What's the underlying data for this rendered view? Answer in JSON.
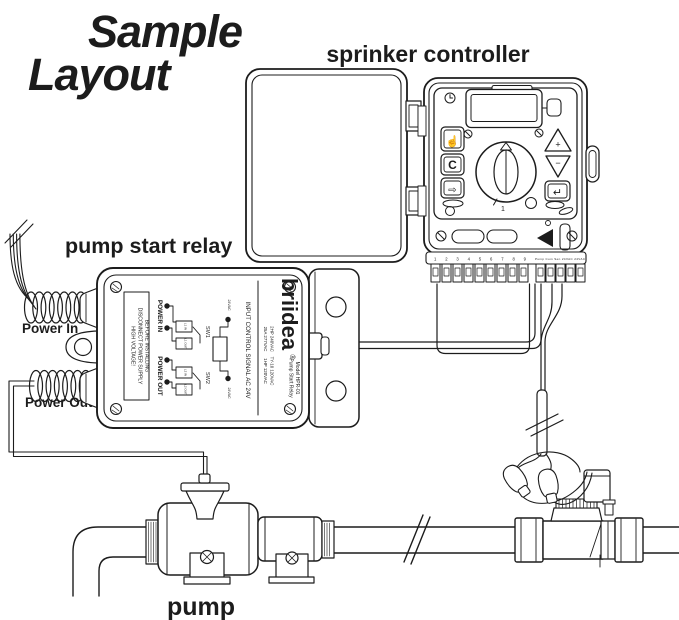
{
  "colors": {
    "accent": "#4f9c87",
    "line": "#1c1c1c"
  },
  "title": {
    "line1": "Sample",
    "line2": "Layout"
  },
  "labels": {
    "controller": "sprinker controller",
    "relay": "pump start relay",
    "power_in": "Power In",
    "power_out": "Power Out",
    "pump": "pump"
  },
  "relay_panel": {
    "brand": "briidea",
    "reg": "®",
    "model_line1": "Pump Start Relay",
    "model_line2": "Model HPR-01",
    "rating1a": "25A 277VAC",
    "rating1b": "2HP 240VAC",
    "rating2a": "1HP 120VAC",
    "rating2b": "TY-10 120VAC",
    "warning1": "HIGH VOLTAGE!",
    "warning2": "DISCONNECT POWER SUPPLY",
    "warning3": "BEFORE INSTALLING",
    "power_in": "POWER IN",
    "power_out": "POWER OUT",
    "sw1": "SW1",
    "sw2": "SW2",
    "t1": "L1 IN",
    "t2": "L1 OUT",
    "t3": "L2 IN",
    "t4": "L2 OUT",
    "vac_top": "24VAC",
    "vac_bot": "24VAC",
    "signal": "INPUT CONTROL SIGNAL AC 24V"
  },
  "controller_panel": {
    "btn_manual": "☝",
    "btn_c": "C",
    "btn_next": "⇨",
    "btn_plus": "+",
    "btn_minus": "−",
    "btn_enter": "↵",
    "dial_pos": "1",
    "terminal_numbers": "1 2 3 4 5 6 7 8 9",
    "terminal_labels": "Pump Com Sen 24VAC 24VAC"
  }
}
